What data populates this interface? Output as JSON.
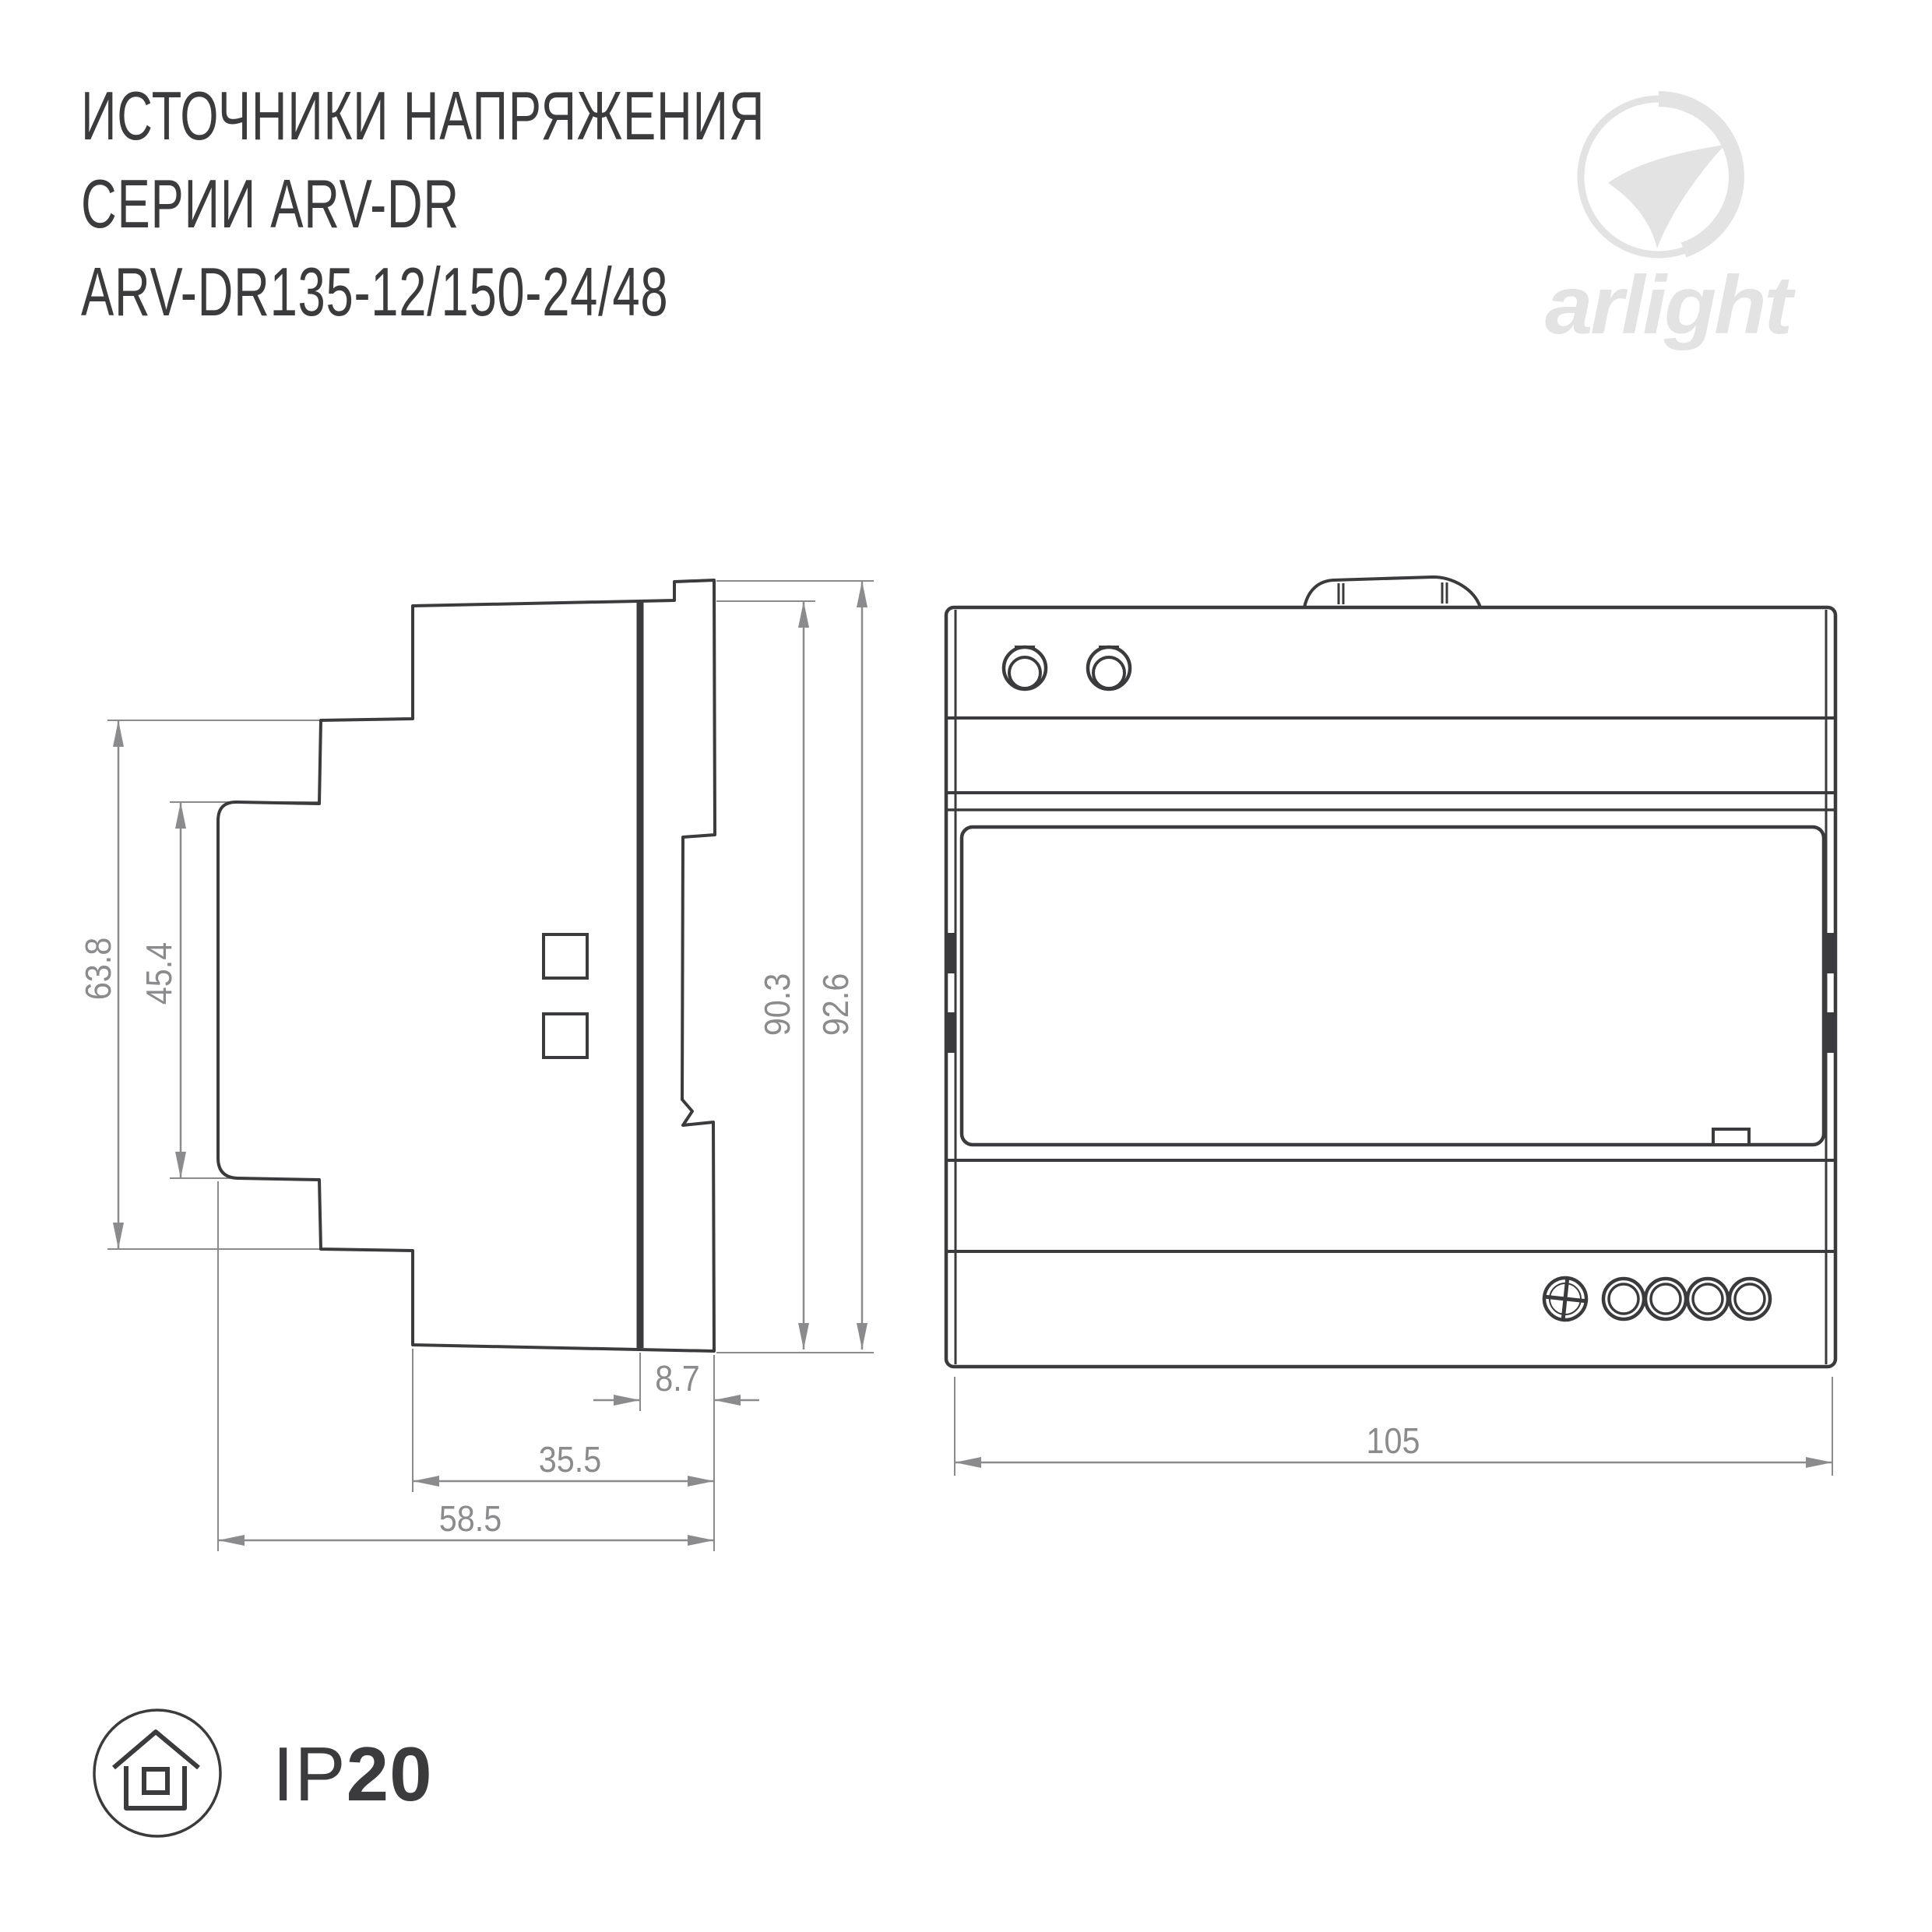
{
  "header": {
    "line1": "ИСТОЧНИКИ НАПРЯЖЕНИЯ",
    "line2": "СЕРИИ ARV-DR",
    "line3": "ARV-DR135-12/150-24/48"
  },
  "logo": {
    "brand": "arlight"
  },
  "drawing": {
    "side_view": {
      "dim_outer_height": "63.8",
      "dim_inner_height": "45.4",
      "dim_body_height": "90.3",
      "dim_total_height": "92.6",
      "dim_rail_offset": "8.7",
      "dim_body_depth": "35.5",
      "dim_total_depth": "58.5"
    },
    "front_view": {
      "dim_width": "105"
    }
  },
  "badge": {
    "ip_prefix": "IP",
    "ip_value": "20"
  },
  "colors": {
    "line": "#3b3b3d",
    "dimension": "#8b8b8d",
    "logo": "#e3e3e4"
  }
}
